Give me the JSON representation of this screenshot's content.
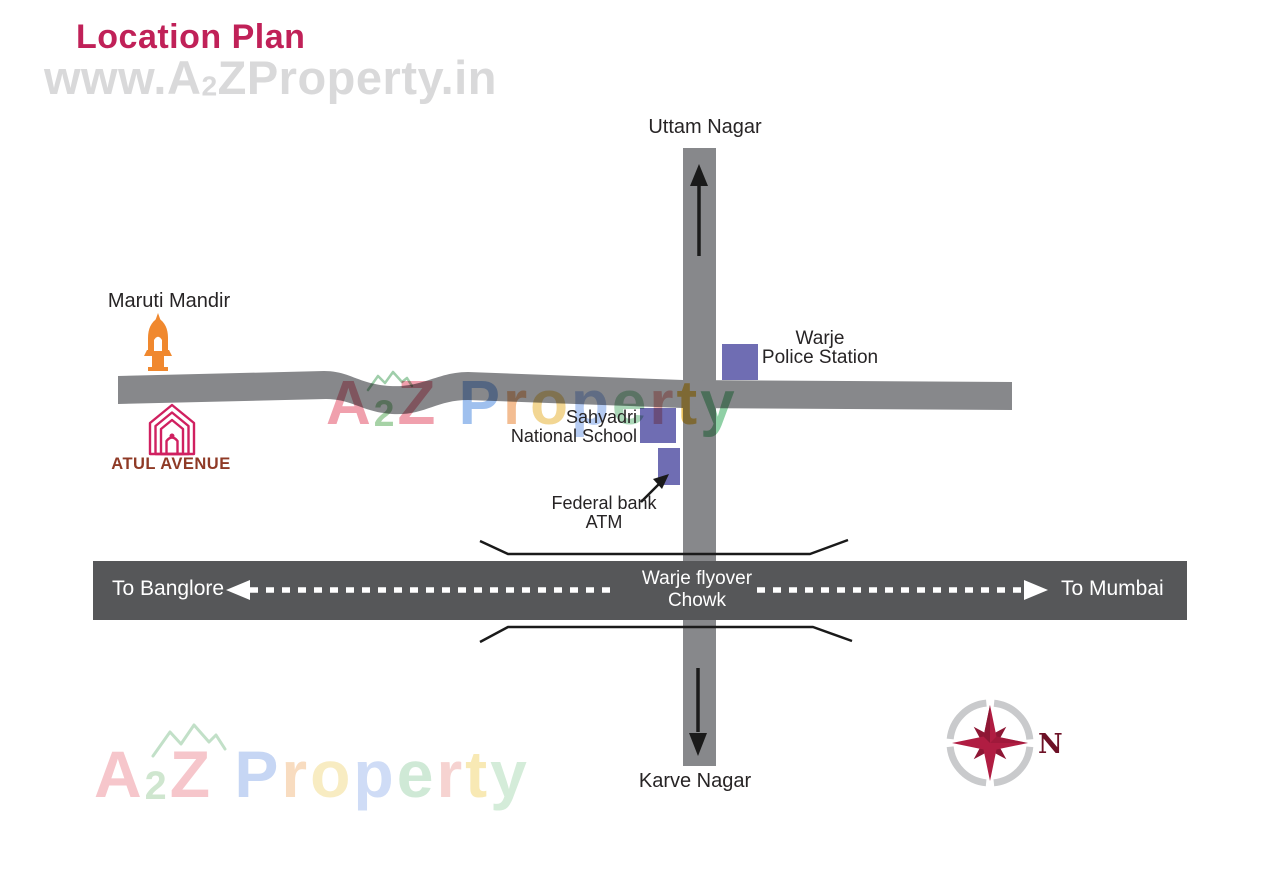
{
  "header": {
    "title": "Location Plan"
  },
  "watermarks": {
    "top": {
      "letters": [
        {
          "ch": "www.A"
        },
        {
          "ch": "2",
          "small": true
        },
        {
          "ch": "ZProperty.in"
        }
      ]
    },
    "center": {
      "letters": [
        {
          "ch": "A",
          "color": "#f0a0ad"
        },
        {
          "ch": "2",
          "color": "#a6d2a6",
          "small": true
        },
        {
          "ch": "Z",
          "color": "#f0a0ad"
        },
        {
          "ch": " "
        },
        {
          "ch": "P",
          "color": "#9fc0ee"
        },
        {
          "ch": "r",
          "color": "#f3bd92"
        },
        {
          "ch": "o",
          "color": "#f2d693"
        },
        {
          "ch": "p",
          "color": "#b5cbf2"
        },
        {
          "ch": "e",
          "color": "#abd8b8"
        },
        {
          "ch": "r",
          "color": "#f1b3af"
        },
        {
          "ch": "t",
          "color": "#eec45e"
        },
        {
          "ch": "y",
          "color": "#8fd0a5"
        }
      ]
    },
    "bottom": {
      "letters": [
        {
          "ch": "A",
          "color": "#f6c6cb"
        },
        {
          "ch": "2",
          "color": "#cfe6cf",
          "small": true
        },
        {
          "ch": "Z",
          "color": "#f6c6cb"
        },
        {
          "ch": " "
        },
        {
          "ch": "P",
          "color": "#c6d6f4"
        },
        {
          "ch": "r",
          "color": "#f8dcc0"
        },
        {
          "ch": "o",
          "color": "#f8ecc2"
        },
        {
          "ch": "p",
          "color": "#cfdcf6"
        },
        {
          "ch": "e",
          "color": "#cfe9d6"
        },
        {
          "ch": "r",
          "color": "#f6d3d1"
        },
        {
          "ch": "t",
          "color": "#f8e9b4"
        },
        {
          "ch": "y",
          "color": "#d4ecd9"
        }
      ]
    }
  },
  "map": {
    "north_label": "Uttam Nagar",
    "south_label": "Karve Nagar",
    "maruti_mandir": "Maruti Mandir",
    "atul_avenue": "ATUL AVENUE",
    "police": {
      "line1": "Warje",
      "line2": "Police Station"
    },
    "school": {
      "line1": "Sahyadri",
      "line2": "National School"
    },
    "atm": {
      "line1": "Federal bank",
      "line2": "ATM"
    }
  },
  "highway": {
    "west": "To Banglore",
    "center_line1": "Warje flyover",
    "center_line2": "Chowk",
    "east": "To Mumbai"
  },
  "compass": {
    "n": "N"
  },
  "colors": {
    "road_gray": "#87888b",
    "highway_gray": "#565759",
    "building_purple": "#6f6db3",
    "title_pink": "#c02158",
    "atul_pink": "#d02060",
    "atul_text": "#8f3a26",
    "mandir_orange": "#f0882e",
    "compass_ring": "#c9cacc",
    "compass_star": "#b01d42",
    "compass_star_dark": "#8e1634",
    "compass_n": "#6d1126",
    "text_black": "#272425",
    "band_text": "#ffffff",
    "watermark_gray": "#d9d9da"
  }
}
